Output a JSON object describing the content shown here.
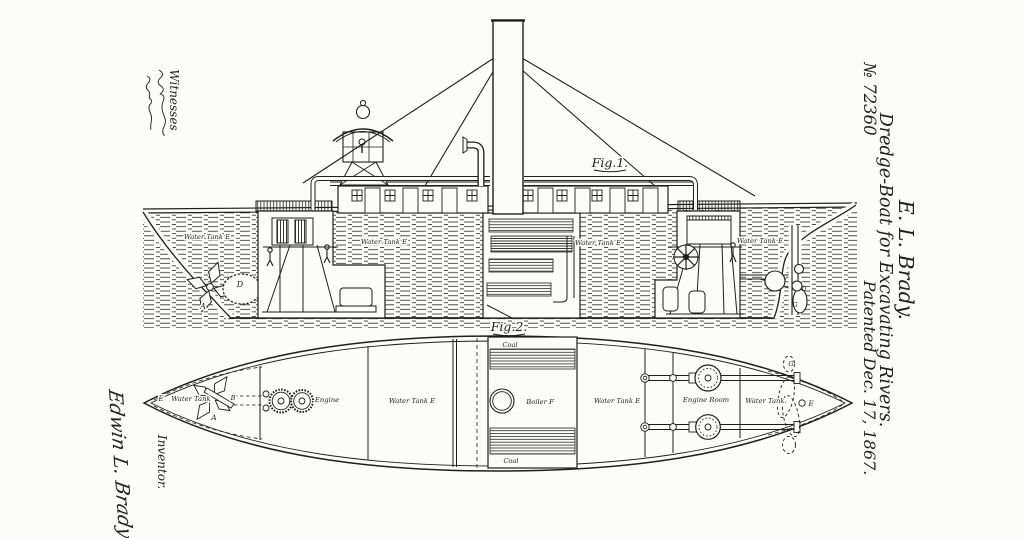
{
  "margin_right": {
    "patentee": "E. L. Brady.",
    "title": "Dredge-Boat for Excavating Rivers.",
    "patent_number": "№ 72360",
    "patent_date": "Patented Dec. 17, 1867."
  },
  "margin_left": {
    "witnesses_label": "Witnesses",
    "inventor_label": "Inventor.",
    "inventor_signature": "Edwin L. Brady"
  },
  "fig1": {
    "caption": "Fig.1.",
    "labels": {
      "water_tank_bow": "Water Tank E",
      "water_tank_mid": "Water Tank E",
      "water_tank_aft": "Water Tank E",
      "water_tank_stern": "Water Tank E",
      "cutter_letter": "A",
      "drum_letter": "D",
      "stern_hub_letter": "D",
      "stern_prop_letter": "G"
    }
  },
  "fig2": {
    "caption": "Fig.2.",
    "labels": {
      "coal_fore": "Coal",
      "coal_aft": "Coal",
      "bow_letter_e": "E",
      "water_tank_bow": "Water Tank",
      "cutter_letter": "A",
      "shaft_letter": "B",
      "engine": "Engine",
      "water_tank_port": "Water Tank E",
      "boiler": "Boiler F",
      "water_tank_stbd": "Water Tank E",
      "engine_room": "Engine Room",
      "water_tank_stern": "Water Tank.",
      "stern_prop_letter": "G",
      "stern_letter_e": "E"
    }
  }
}
